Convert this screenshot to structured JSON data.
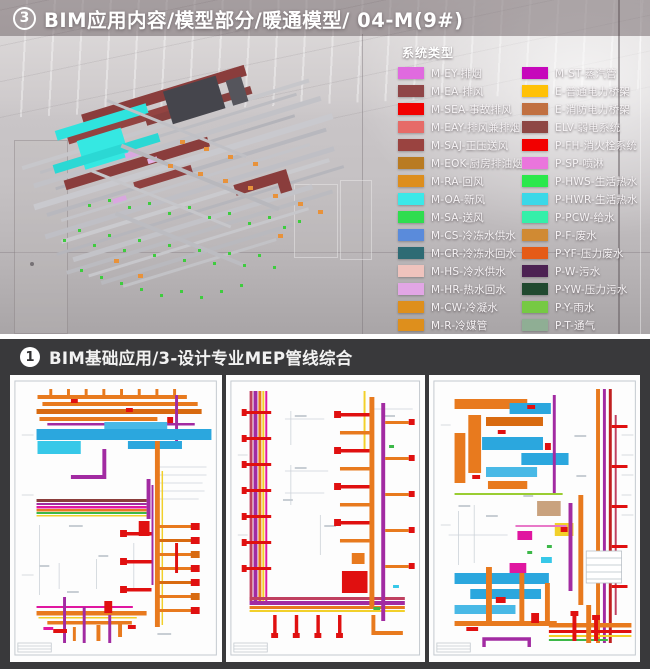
{
  "top_section": {
    "badge": "3",
    "title": "BIM应用内容/模型部分/暖通模型/ 04-M(9#)",
    "legend": {
      "title": "系统类型",
      "col1": [
        {
          "label": "M-EY-排烟",
          "color": "#E06ADF"
        },
        {
          "label": "M-EA-排风",
          "color": "#8F4547"
        },
        {
          "label": "M-SEA-事故排风",
          "color": "#F20000"
        },
        {
          "label": "M-EAY-排风兼排烟",
          "color": "#E66B68"
        },
        {
          "label": "M-SAJ-正压送风",
          "color": "#9A4340"
        },
        {
          "label": "M-EOK-厨房排油烟",
          "color": "#B97B22"
        },
        {
          "label": "M-RA-回风",
          "color": "#DD8E1E"
        },
        {
          "label": "M-OA-新风",
          "color": "#3BE8E8"
        },
        {
          "label": "M-SA-送风",
          "color": "#2FDD4F"
        },
        {
          "label": "M-CS-冷冻水供水",
          "color": "#5A8BDB"
        },
        {
          "label": "M-CR-冷冻水回水",
          "color": "#2E6B74"
        },
        {
          "label": "M-HS-冷水供水",
          "color": "#EFC3BD"
        },
        {
          "label": "M-HR-热水回水",
          "color": "#E2A6E5"
        },
        {
          "label": "M-CW-冷凝水",
          "color": "#DE8F1C"
        },
        {
          "label": "M-R-冷媒管",
          "color": "#DE8F1C"
        }
      ],
      "col2": [
        {
          "label": "M-ST-蒸汽管",
          "color": "#C607BB"
        },
        {
          "label": "E-普通电力桥架",
          "color": "#FFC107"
        },
        {
          "label": "E-消防电力桥架",
          "color": "#C17041"
        },
        {
          "label": "ELV-弱电系统",
          "color": "#8E4745"
        },
        {
          "label": "P-FH-消火栓系统",
          "color": "#F20000"
        },
        {
          "label": "P-SP-喷淋",
          "color": "#EA75DC"
        },
        {
          "label": "P-HWS-生活热水",
          "color": "#2BE84C"
        },
        {
          "label": "P-HWR-生活热水",
          "color": "#3BD8E8"
        },
        {
          "label": "P-PCW-给水",
          "color": "#35EFA9"
        },
        {
          "label": "P-F-废水",
          "color": "#D08A33"
        },
        {
          "label": "P-YF-压力废水",
          "color": "#E55B17"
        },
        {
          "label": "P-W-污水",
          "color": "#4C2152"
        },
        {
          "label": "P-YW-压力污水",
          "color": "#20492F"
        },
        {
          "label": "P-Y-雨水",
          "color": "#76C943"
        },
        {
          "label": "P-T-通气",
          "color": "#8FAE94"
        }
      ]
    }
  },
  "bottom_section": {
    "badge": "1",
    "title": "BIM基础应用/3-设计专业MEP管线综合"
  }
}
